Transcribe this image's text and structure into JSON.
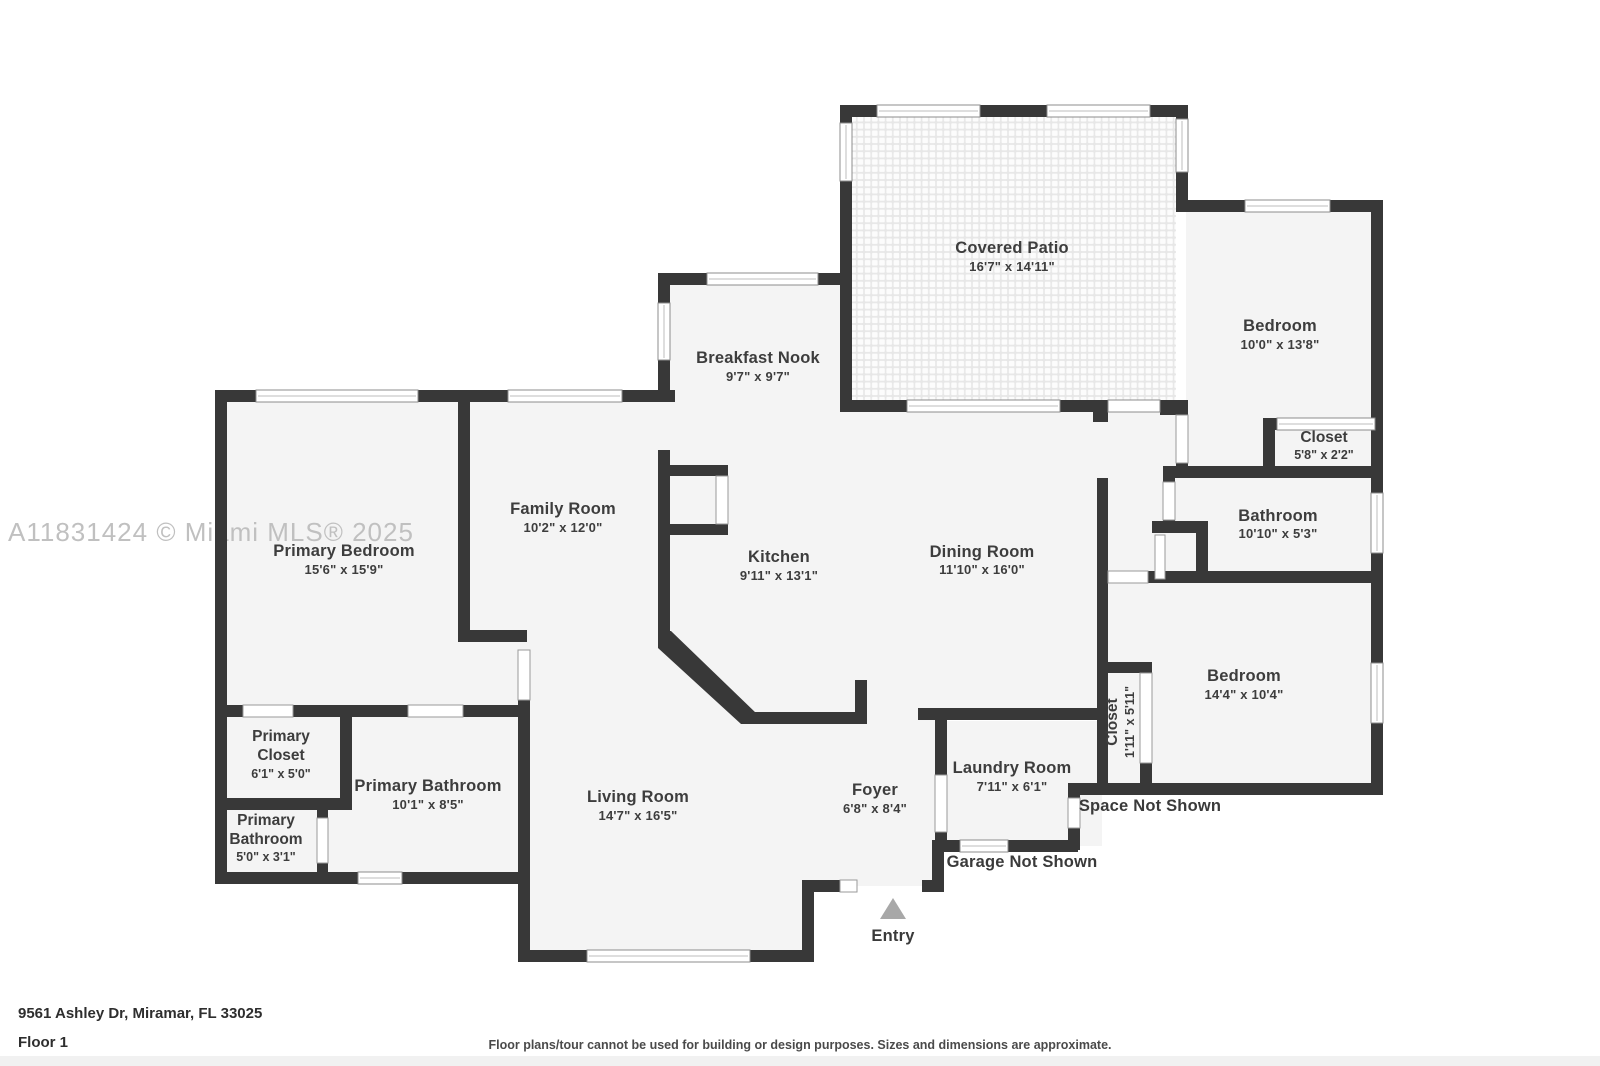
{
  "watermark": "A11831424 © Miami MLS® 2025",
  "footer": {
    "address": "9561 Ashley Dr, Miramar, FL 33025",
    "floor": "Floor 1",
    "disclaimer": "Floor plans/tour cannot be used for building or design purposes. Sizes and dimensions are approximate."
  },
  "annotations": {
    "space_not_shown": "Space Not Shown",
    "garage_not_shown": "Garage Not Shown",
    "entry": "Entry"
  },
  "rooms": {
    "covered_patio": {
      "name": "Covered Patio",
      "dims": "16'7\" x 14'11\""
    },
    "breakfast_nook": {
      "name": "Breakfast Nook",
      "dims": "9'7\" x 9'7\""
    },
    "bedroom_top": {
      "name": "Bedroom",
      "dims": "10'0\" x 13'8\""
    },
    "closet_top": {
      "name": "Closet",
      "dims": "5'8\" x 2'2\""
    },
    "bathroom": {
      "name": "Bathroom",
      "dims": "10'10\" x 5'3\""
    },
    "family_room": {
      "name": "Family Room",
      "dims": "10'2\" x 12'0\""
    },
    "primary_bedroom": {
      "name": "Primary Bedroom",
      "dims": "15'6\" x 15'9\""
    },
    "kitchen": {
      "name": "Kitchen",
      "dims": "9'11\" x 13'1\""
    },
    "dining_room": {
      "name": "Dining Room",
      "dims": "11'10\" x 16'0\""
    },
    "bedroom_right": {
      "name": "Bedroom",
      "dims": "14'4\" x 10'4\""
    },
    "closet_hall": {
      "name": "Closet",
      "dims": "1'11\" x 5'11\""
    },
    "primary_closet": {
      "line1": "Primary",
      "line2": "Closet",
      "dims": "6'1\" x 5'0\""
    },
    "primary_bathroom": {
      "name": "Primary Bathroom",
      "dims": "10'1\" x 8'5\""
    },
    "primary_bathroom_sm": {
      "line1": "Primary",
      "line2": "Bathroom",
      "dims": "5'0\" x 3'1\""
    },
    "living_room": {
      "name": "Living Room",
      "dims": "14'7\" x 16'5\""
    },
    "foyer": {
      "name": "Foyer",
      "dims": "6'8\" x 8'4\""
    },
    "laundry_room": {
      "name": "Laundry Room",
      "dims": "7'11\" x 6'1\""
    }
  }
}
